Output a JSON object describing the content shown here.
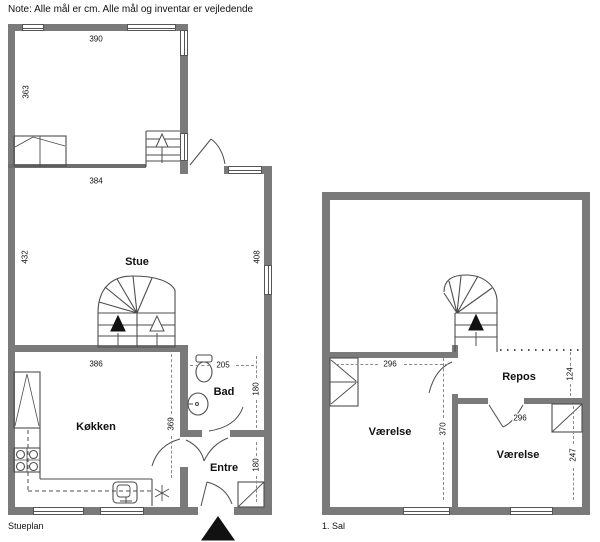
{
  "note": "Note: Alle mål er cm. Alle mål og inventar er vejledende",
  "ground_floor": {
    "plan_label": "Stueplan",
    "rooms": {
      "stue": "Stue",
      "kokken": "Køkken",
      "bad": "Bad",
      "entre": "Entre"
    },
    "dims": {
      "top_room_width": "390",
      "top_room_left": "363",
      "stue_top": "384",
      "stue_left": "432",
      "stue_right": "408",
      "stue_bottom": "386",
      "bad_top": "205",
      "bad_right": "180",
      "kokken_right": "369",
      "entre_right": "180"
    }
  },
  "first_floor": {
    "plan_label": "1. Sal",
    "rooms": {
      "varelse_left": "Værelse",
      "repos": "Repos",
      "varelse_right": "Værelse"
    },
    "dims": {
      "varelse_left_top": "296",
      "varelse_left_right": "370",
      "repos_right": "124",
      "varelse_right_door": "296",
      "varelse_right_side": "247"
    }
  },
  "colors": {
    "wall": "#7a7a7a",
    "line": "#4d4d4d",
    "text": "#111111"
  }
}
